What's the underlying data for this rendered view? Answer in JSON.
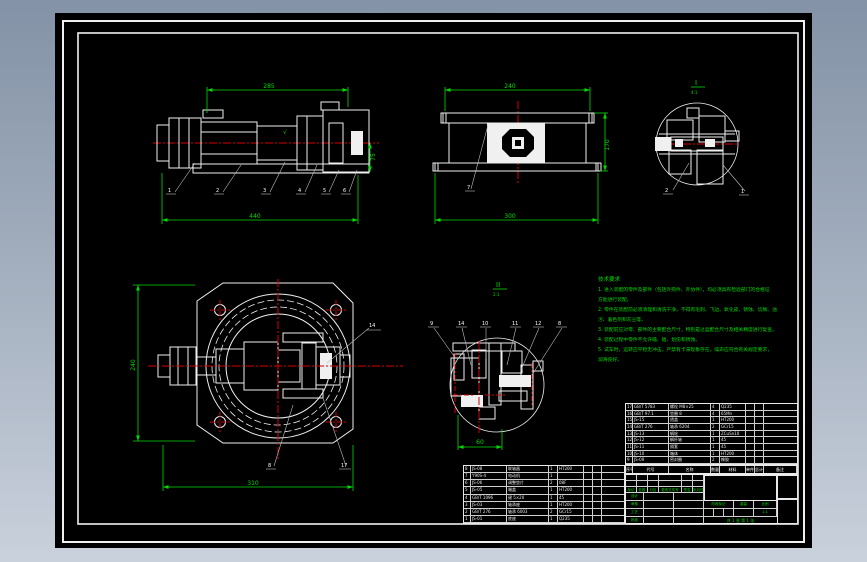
{
  "colors": {
    "accent_green": "#00dc00",
    "accent_red": "#d80000",
    "accent_cyan": "#00e0e0",
    "line_white": "#f0f0f0",
    "canvas_bg": "#000000",
    "surround_top": "#8392a6",
    "surround_bottom": "#c9d1dc"
  },
  "views": {
    "side": {
      "dim_top": "285",
      "dim_right": "75",
      "dim_bottom": "440",
      "surface_mark": "√",
      "balloons": [
        "1",
        "2",
        "3",
        "4",
        "5",
        "6"
      ]
    },
    "front": {
      "dim_top": "240",
      "dim_right": "170",
      "dim_bottom": "300",
      "balloon": "7"
    },
    "detail_i": {
      "label": "I",
      "scale": "4:1",
      "balloons": [
        "2",
        "1"
      ]
    },
    "top": {
      "dim_left": "240",
      "dim_bottom": "310",
      "balloons": [
        "14",
        "8",
        "17"
      ]
    },
    "detail_ii": {
      "label": "II",
      "scale": "2:1",
      "dim_bottom": "60",
      "balloons": [
        "9",
        "14",
        "10",
        "11",
        "12",
        "8"
      ]
    }
  },
  "notes": {
    "title": "技术要求",
    "lines": [
      "1. 进入装配的零件及部件（包括外购件、外协件），均必须具有检验部门的合格证",
      "方能进行装配。",
      "2. 零件在装配前必须清理和清洗干净，不得有毛刺、飞边、氧化皮、锈蚀、切屑、油",
      "污、着色剂和灰尘等。",
      "3. 装配前应对零、部件的主要配合尺寸，特别是过盈配合尺寸及相关精度进行复查。",
      "4. 装配过程中零件不允许磕、碰、划伤和锈蚀。",
      "5. 试车时，运转应平稳无冲击，严禁有卡滞现象存在，噪声应符合有关规定要求，",
      "润滑良好。"
    ]
  },
  "bom": {
    "header": [
      "序号",
      "代号",
      "名称",
      "数量",
      "材料",
      "单件",
      "总计",
      "备注"
    ],
    "upper": [
      {
        "no": "17",
        "code": "GB/T 5783",
        "name": "螺栓 M8×25",
        "qty": "4",
        "mat": "Q235",
        "w1": "",
        "w2": "",
        "rk": ""
      },
      {
        "no": "16",
        "code": "GB/T 97.1",
        "name": "垫圈 8",
        "qty": "4",
        "mat": "65Mn",
        "w1": "",
        "w2": "",
        "rk": ""
      },
      {
        "no": "15",
        "code": "JS-15",
        "name": "透盖",
        "qty": "1",
        "mat": "HT200",
        "w1": "",
        "w2": "",
        "rk": ""
      },
      {
        "no": "14",
        "code": "GB/T 276",
        "name": "轴承 6204",
        "qty": "2",
        "mat": "GCr15",
        "w1": "",
        "w2": "",
        "rk": ""
      },
      {
        "no": "13",
        "code": "JS-13",
        "name": "蜗轮",
        "qty": "1",
        "mat": "ZCuSn10",
        "w1": "",
        "w2": "",
        "rk": ""
      },
      {
        "no": "12",
        "code": "JS-12",
        "name": "蜗杆轴",
        "qty": "1",
        "mat": "45",
        "w1": "",
        "w2": "",
        "rk": ""
      },
      {
        "no": "11",
        "code": "JS-11",
        "name": "隔套",
        "qty": "1",
        "mat": "45",
        "w1": "",
        "w2": "",
        "rk": ""
      },
      {
        "no": "10",
        "code": "JS-10",
        "name": "箱体",
        "qty": "1",
        "mat": "HT200",
        "w1": "",
        "w2": "",
        "rk": ""
      },
      {
        "no": "9",
        "code": "JS-09",
        "name": "密封圈",
        "qty": "2",
        "mat": "橡胶",
        "w1": "",
        "w2": "",
        "rk": ""
      }
    ],
    "lower": [
      {
        "no": "8",
        "code": "JS-08",
        "name": "联轴器",
        "qty": "1",
        "mat": "HT200",
        "w1": "",
        "w2": "",
        "rk": ""
      },
      {
        "no": "7",
        "code": "Y90S-4",
        "name": "电动机",
        "qty": "1",
        "mat": "",
        "w1": "",
        "w2": "",
        "rk": ""
      },
      {
        "no": "6",
        "code": "JS-06",
        "name": "调整垫片",
        "qty": "2",
        "mat": "08F",
        "w1": "",
        "w2": "",
        "rk": ""
      },
      {
        "no": "5",
        "code": "JS-05",
        "name": "端盖",
        "qty": "1",
        "mat": "HT200",
        "w1": "",
        "w2": "",
        "rk": ""
      },
      {
        "no": "4",
        "code": "GB/T 1096",
        "name": "键 5×20",
        "qty": "1",
        "mat": "45",
        "w1": "",
        "w2": "",
        "rk": ""
      },
      {
        "no": "3",
        "code": "JS-03",
        "name": "轴承座",
        "qty": "1",
        "mat": "HT200",
        "w1": "",
        "w2": "",
        "rk": ""
      },
      {
        "no": "2",
        "code": "GB/T 276",
        "name": "轴承 6003",
        "qty": "2",
        "mat": "GCr15",
        "w1": "",
        "w2": "",
        "rk": ""
      },
      {
        "no": "1",
        "code": "JS-01",
        "name": "底座",
        "qty": "1",
        "mat": "Q235",
        "w1": "",
        "w2": "",
        "rk": ""
      }
    ]
  },
  "title_block": {
    "change_row": [
      "标记",
      "处数",
      "分区",
      "更改文件号",
      "签名",
      "年月日"
    ],
    "design": "设计",
    "check": "审核",
    "process": "工艺",
    "approve": "批准",
    "stage": "阶段标记",
    "weight": "重量",
    "scale": "比例",
    "scale_value": "1:1",
    "sheet": "共 1 张 第 1 张"
  }
}
